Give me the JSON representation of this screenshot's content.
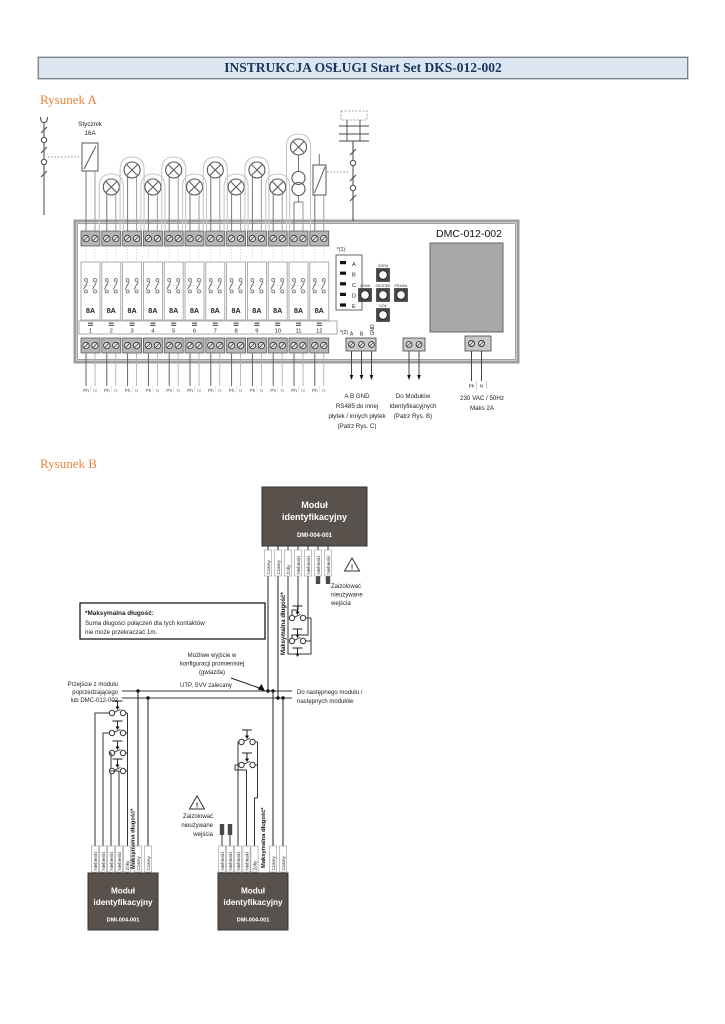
{
  "doc": {
    "title": "INSTRUKCJA OSŁUGI Start Set DKS-012-002"
  },
  "figure_a": {
    "caption": "Rysunek A",
    "device": "DMC-012-002",
    "contactor": [
      "Stycznik",
      "16A"
    ],
    "relay_amp": "8A",
    "channels": [
      "1",
      "2",
      "3",
      "4",
      "5",
      "6",
      "7",
      "8",
      "9",
      "10",
      "11",
      "12"
    ],
    "note1": "*(1)",
    "note2": "*(2)",
    "leds": [
      "A",
      "B",
      "C",
      "D",
      "E"
    ],
    "buttons": {
      "up": "GÓRA",
      "left": "LEWA",
      "center": "ŚRODEK",
      "right": "PRAWA",
      "down": "DÓŁ"
    },
    "bus_terminals": [
      "A",
      "B",
      "GND"
    ],
    "phase_pair": [
      "Ph",
      "N"
    ],
    "ann_rs485": [
      "A B GND",
      "RS485 do innej",
      "płytek / innych płytek",
      "(Patrz Rys. C)"
    ],
    "ann_modules": [
      "Do Modułów",
      "Identyfikacyjnych",
      "(Patrz Rys. B)"
    ],
    "ann_power": {
      "ph": "Ph",
      "n": "N",
      "l1": "230 VAC / 50Hz",
      "l2": "Maks 2A"
    }
  },
  "figure_b": {
    "caption": "Rysunek B",
    "module": {
      "title1": "Moduł",
      "title2": "identyfikacyjny",
      "code": "DMI-004-001"
    },
    "wire_colors_top": [
      "Czarny",
      "Czarny",
      "Żółty",
      "Niebieski",
      "Niebieski",
      "Niebieski",
      "Niebieski"
    ],
    "wire_colors_left": [
      "Niebieski",
      "Niebieski",
      "Niebieski",
      "Niebieski",
      "Żółty",
      "Czarny",
      "Czarny"
    ],
    "wire_colors_mid": [
      "Niebieski",
      "Niebieski",
      "Niebieski",
      "Niebieski",
      "Żółty",
      "Czarny",
      "Czarny"
    ],
    "max_length": "Maksymalna długość*",
    "note": [
      "*Maksymalna długość:",
      "Suma długości połączeń dla tych kontaktów",
      "nie może przekraczać 1m."
    ],
    "star": [
      "Możliwe wyjście w",
      "konfiguracji promienistej",
      "(gwiazda)"
    ],
    "incoming": [
      "Przejście z modułu",
      "poprzedzającego",
      "lub DMC-012-002"
    ],
    "cable": "UTP, SVV zalecany",
    "outgoing": [
      "Do następnego modułu /",
      "następnych modułów"
    ],
    "warning": [
      "Zaizolować",
      "nieużywane",
      "wejścia"
    ],
    "warning_icon": "!"
  }
}
